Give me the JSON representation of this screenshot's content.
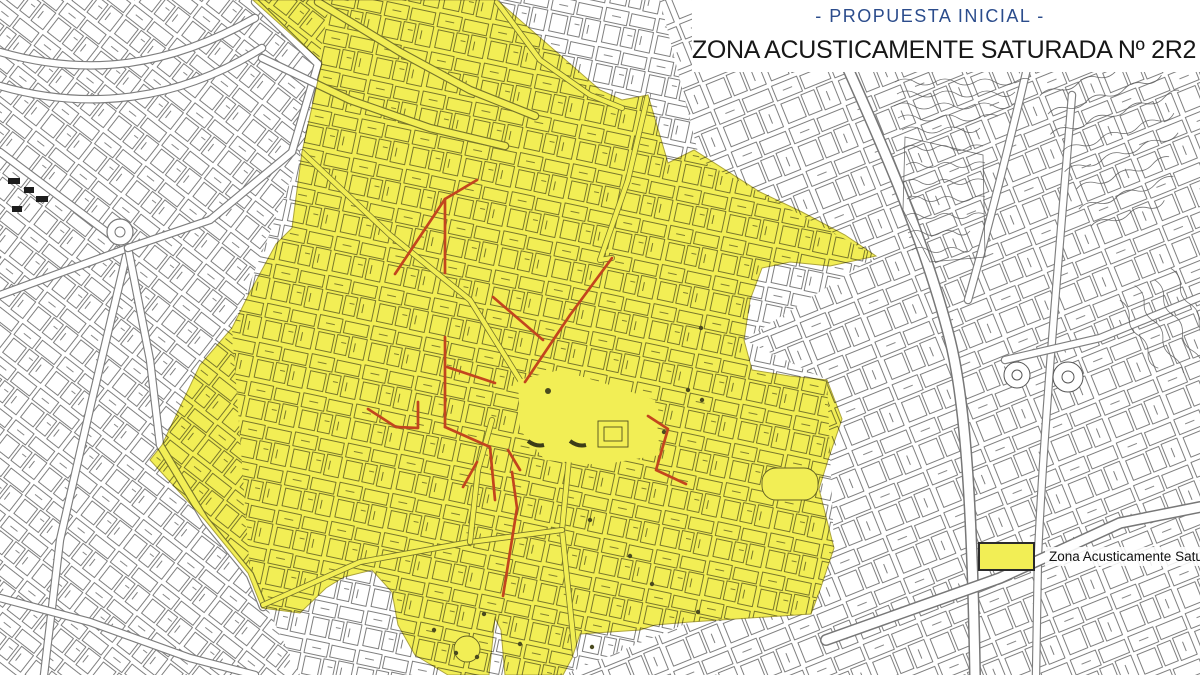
{
  "title_block": {
    "proposal_label": "- PROPUESTA INICIAL -",
    "zone_title": "ZONA ACUSTICAMENTE SATURADA Nº 2R2"
  },
  "legend": {
    "items": [
      {
        "label": "Zona Acusticamente Saturada",
        "swatch_color": "#F2EE55"
      }
    ]
  },
  "map": {
    "colors": {
      "saturated_zone_fill": "#F2EE55",
      "highlighted_streets_red": "#C2451E",
      "proposal_title_blue": "#2B4C8C",
      "cadastral_line": "#4D4D4D"
    }
  }
}
